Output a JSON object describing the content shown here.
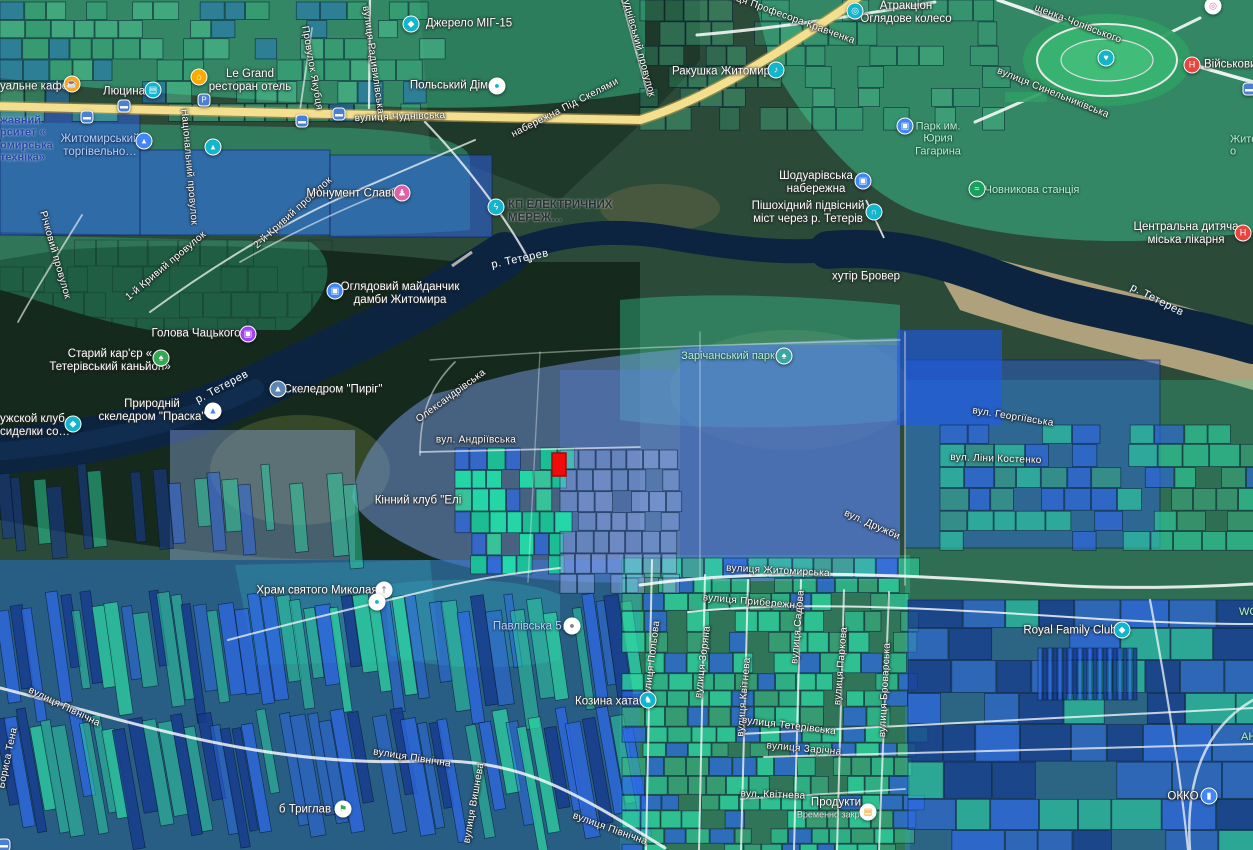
{
  "map": {
    "type": "satellite-cadastral-map",
    "colors": {
      "overlay_green": "#3fd69f",
      "overlay_blue": "#2f6be0",
      "water": "#0c2440",
      "road_yellow": "#f3df8d",
      "selected_parcel_red": "#f30b0b"
    },
    "selected_parcel": {
      "x": 552,
      "y": 453,
      "w": 14,
      "h": 23,
      "fill": "#f30b0b",
      "stroke": "#9e0b0b"
    },
    "street_labels": [
      {
        "n": "street-chudnivska",
        "t": "вулиця Чуднівська",
        "x": 400,
        "y": 117,
        "r": -2
      },
      {
        "n": "street-pid-skeliamy",
        "t": "набережна Під Скелями",
        "x": 565,
        "y": 108,
        "r": -27
      },
      {
        "n": "street-radyvylivska",
        "t": "вулиця Радивилівська",
        "x": 373,
        "y": 60,
        "r": 82
      },
      {
        "n": "street-chudnivskyi-provulok",
        "t": "Чуднівський провулок",
        "x": 638,
        "y": 45,
        "r": 75
      },
      {
        "n": "street-provulok-yakubtsia",
        "t": "Провулок Якубця",
        "x": 312,
        "y": 68,
        "r": 80
      },
      {
        "n": "street-profesora-kravchenka",
        "t": "вулиця Професора Кравченка",
        "x": 785,
        "y": 16,
        "r": 20
      },
      {
        "n": "street-chopivskoho",
        "t": "щенка-Чопівського",
        "x": 1078,
        "y": 24,
        "r": 21
      },
      {
        "n": "street-synelnykivska",
        "t": "вулиця Синельниківська",
        "x": 1053,
        "y": 93,
        "r": 22
      },
      {
        "n": "street-richkovyi-provulok",
        "t": "Річковий провулок",
        "x": 55,
        "y": 255,
        "r": 74
      },
      {
        "n": "street-1-kryvyi-provulok",
        "t": "1-й Кривий провулок",
        "x": 166,
        "y": 266,
        "r": -40
      },
      {
        "n": "street-2-kryvyi-provulok",
        "t": "2-й Кривий провулок",
        "x": 293,
        "y": 213,
        "r": -42
      },
      {
        "n": "street-natsionalnyi-provulok",
        "t": "Національний провулок",
        "x": 189,
        "y": 167,
        "r": 85
      },
      {
        "n": "street-andriivska",
        "t": "вул. Андріївська",
        "x": 476,
        "y": 440,
        "r": 0
      },
      {
        "n": "street-oleksandrivska",
        "t": "Олександрівська",
        "x": 451,
        "y": 396,
        "r": -36
      },
      {
        "n": "street-heorhiivska",
        "t": "вул. Георгіївська",
        "x": 1013,
        "y": 417,
        "r": 9
      },
      {
        "n": "street-liny-kostenko",
        "t": "вул. Ліни Костенко",
        "x": 996,
        "y": 459,
        "r": 2
      },
      {
        "n": "street-druzhby",
        "t": "вул. Дружби",
        "x": 872,
        "y": 525,
        "r": 24
      },
      {
        "n": "street-zhytomyrska",
        "t": "вулиця Житомирська",
        "x": 778,
        "y": 571,
        "r": 3
      },
      {
        "n": "street-pryberezhna",
        "t": "вулиця Прибережна",
        "x": 752,
        "y": 602,
        "r": 5
      },
      {
        "n": "street-polova",
        "t": "вулиця Польова",
        "x": 652,
        "y": 660,
        "r": -83
      },
      {
        "n": "street-zoriana",
        "t": "вулиця Зоряна",
        "x": 703,
        "y": 662,
        "r": -83
      },
      {
        "n": "street-kvitneva-vertical",
        "t": "вулиця Квітнева",
        "x": 744,
        "y": 697,
        "r": -85
      },
      {
        "n": "street-sadova",
        "t": "вулиця Садова",
        "x": 798,
        "y": 627,
        "r": -85
      },
      {
        "n": "street-parkova",
        "t": "вулиця Паркова",
        "x": 841,
        "y": 666,
        "r": -85
      },
      {
        "n": "street-brovarska",
        "t": "вулиця Броварська",
        "x": 885,
        "y": 690,
        "r": -87
      },
      {
        "n": "street-teterivska",
        "t": "вулиця Тетерівська",
        "x": 789,
        "y": 726,
        "r": 7
      },
      {
        "n": "street-zarichna",
        "t": "вулиця Зарічна",
        "x": 804,
        "y": 749,
        "r": 5
      },
      {
        "n": "street-kvitneva-lane",
        "t": "вул. Квітнева",
        "x": 773,
        "y": 795,
        "r": 2
      },
      {
        "n": "street-pivnichna-1",
        "t": "вулиця Північна",
        "x": 610,
        "y": 829,
        "r": 20
      },
      {
        "n": "street-pivnichna-2",
        "t": "вулиця Північна",
        "x": 412,
        "y": 758,
        "r": 9
      },
      {
        "n": "street-pivnichna-3",
        "t": "вулиця Північна",
        "x": 25,
        "y": 707,
        "r": 26,
        "align": "left"
      },
      {
        "n": "street-vyshneva",
        "t": "вулиця Вишнева",
        "x": 474,
        "y": 803,
        "r": -80
      },
      {
        "n": "street-borysa-tena",
        "t": "Бориса Тена",
        "x": 8,
        "y": 758,
        "r": -78
      }
    ],
    "river_labels": [
      {
        "n": "river-teteriv-1",
        "t": "р. Тетерев",
        "x": 520,
        "y": 259,
        "r": -12
      },
      {
        "n": "river-teteriv-2",
        "t": "р. Тетерев",
        "x": 222,
        "y": 387,
        "r": -28
      },
      {
        "n": "river-teteriv-3",
        "t": "р. Тетерев",
        "x": 1157,
        "y": 300,
        "r": 27
      }
    ],
    "place_labels": [
      {
        "n": "poi-cafe",
        "lines": [
          "уальне кафе"
        ],
        "x": 0,
        "y": 87,
        "cls": "poi",
        "align": "left",
        "icon": {
          "n": "cafe-icon",
          "x": 72,
          "y": 84,
          "bg": "#f5a623",
          "glyph": "☕"
        }
      },
      {
        "n": "poi-liutsyna",
        "lines": [
          "Люцина"
        ],
        "x": 124,
        "y": 92,
        "cls": "poi",
        "icon": {
          "n": "shopping-cart-icon",
          "x": 153,
          "y": 90,
          "bg": "#12b5cb",
          "glyph": "▤"
        }
      },
      {
        "n": "poi-le-grand",
        "lines": [
          "Le Grand",
          "ресторан отель"
        ],
        "x": 250,
        "y": 81,
        "cls": "poi",
        "icon": {
          "n": "hotel-icon",
          "x": 199,
          "y": 77,
          "bg": "#f9ab00",
          "glyph": "⌂"
        }
      },
      {
        "n": "poi-dzherelo-mig15",
        "lines": [
          "Джерело МІГ-15"
        ],
        "x": 469,
        "y": 24,
        "cls": "poi",
        "icon": {
          "n": "attraction-icon",
          "x": 411,
          "y": 24,
          "bg": "#12b5cb",
          "glyph": "◆"
        }
      },
      {
        "n": "poi-polskyi-dim",
        "lines": [
          "Польський Дім"
        ],
        "x": 449,
        "y": 86,
        "cls": "poi",
        "icon": {
          "n": "poi-dot-icon",
          "x": 497,
          "y": 86,
          "bg": "#ffffff",
          "fg": "#12b5cb",
          "glyph": "●"
        }
      },
      {
        "n": "poi-rakushka-zhytomyr",
        "lines": [
          "Ракушка Житомир"
        ],
        "x": 721,
        "y": 72,
        "cls": "poi",
        "icon": {
          "n": "music-icon",
          "x": 776,
          "y": 70,
          "bg": "#12b5cb",
          "glyph": "♪"
        }
      },
      {
        "n": "poi-atraktsion-koleso",
        "lines": [
          "Атракціон",
          "Оглядове колесо"
        ],
        "x": 906,
        "y": 13,
        "cls": "poi",
        "icon": {
          "n": "ferris-wheel-icon",
          "x": 855,
          "y": 11,
          "bg": "#12b5cb",
          "glyph": "◎"
        }
      },
      {
        "n": "poi-viiskovyi",
        "lines": [
          "Військови"
        ],
        "x": 1204,
        "y": 65,
        "cls": "poi",
        "align": "left",
        "icon": {
          "n": "hospital-icon",
          "x": 1192,
          "y": 65,
          "bg": "#e8453c",
          "glyph": "Н"
        }
      },
      {
        "n": "poi-park-gagarina",
        "lines": [
          "Парк им.",
          "Юрия",
          "Гагарина"
        ],
        "x": 938,
        "y": 139,
        "cls": "park",
        "icon": {
          "n": "photo-icon",
          "x": 905,
          "y": 126,
          "bg": "#4285f4",
          "glyph": "▣"
        }
      },
      {
        "n": "poi-shoduarivska",
        "lines": [
          "Шодуарівська",
          "набережна"
        ],
        "x": 816,
        "y": 183,
        "cls": "poi",
        "icon": {
          "n": "photo-icon",
          "x": 863,
          "y": 181,
          "bg": "#4285f4",
          "glyph": "▣"
        }
      },
      {
        "n": "poi-pishokhidnyi-mist",
        "lines": [
          "Пішохідний підвісний",
          "міст через р. Тетерів"
        ],
        "x": 808,
        "y": 213,
        "cls": "poi",
        "icon": {
          "n": "bridge-icon",
          "x": 874,
          "y": 212,
          "bg": "#12b5cb",
          "glyph": "∩"
        }
      },
      {
        "n": "poi-chovnykova-stantsiia",
        "lines": [
          "Човникова станція"
        ],
        "x": 1032,
        "y": 190,
        "cls": "park",
        "icon": {
          "n": "boat-station-icon",
          "x": 977,
          "y": 189,
          "bg": "#18a05c",
          "glyph": "≈"
        }
      },
      {
        "n": "poi-dytiacha-likarnia",
        "lines": [
          "Центральна дитяча",
          "міська лікарня"
        ],
        "x": 1186,
        "y": 234,
        "cls": "poi",
        "icon": {
          "n": "hospital-icon",
          "x": 1243,
          "y": 233,
          "bg": "#e8453c",
          "glyph": "Н"
        }
      },
      {
        "n": "poi-zhyto-partial",
        "lines": [
          "Жито",
          "о"
        ],
        "x": 1230,
        "y": 146,
        "cls": "park",
        "align": "left"
      },
      {
        "n": "poi-monument-slavy",
        "lines": [
          "Монумент Слави"
        ],
        "x": 352,
        "y": 194,
        "cls": "poi",
        "icon": {
          "n": "monument-icon",
          "x": 402,
          "y": 193,
          "bg": "#e060a8",
          "glyph": "♟"
        }
      },
      {
        "n": "poi-kp-elektrychnykh",
        "lines": [
          "КП ЕЛЕКТРИЧНИХ",
          "МЕРЕЖ…"
        ],
        "x": 508,
        "y": 212,
        "cls": "dark",
        "align": "left",
        "icon": {
          "n": "electric-icon",
          "x": 496,
          "y": 207,
          "bg": "#12b5cb",
          "glyph": "ϟ"
        }
      },
      {
        "n": "poi-khutir-brover",
        "lines": [
          "хутір Бровер"
        ],
        "x": 866,
        "y": 277,
        "cls": "poi"
      },
      {
        "n": "poi-ohliadovyi-maidanchyk",
        "lines": [
          "Оглядовий майданчик",
          "дамби Житомира"
        ],
        "x": 400,
        "y": 294,
        "cls": "poi",
        "icon": {
          "n": "photo-icon",
          "x": 335,
          "y": 291,
          "bg": "#4285f4",
          "glyph": "▣"
        }
      },
      {
        "n": "poi-holova-chatskoho",
        "lines": [
          "Голова Чацького"
        ],
        "x": 196,
        "y": 334,
        "cls": "poi",
        "icon": {
          "n": "photo-icon",
          "x": 248,
          "y": 334,
          "bg": "#a142f4",
          "glyph": "▣"
        }
      },
      {
        "n": "poi-staryi-karier",
        "lines": [
          "Старий кар'єр «",
          "Тетерівський каньйон»"
        ],
        "x": 110,
        "y": 361,
        "cls": "poi",
        "icon": {
          "n": "nature-icon",
          "x": 161,
          "y": 358,
          "bg": "#34a853",
          "glyph": "♠"
        }
      },
      {
        "n": "poi-skeledrom-pyrih",
        "lines": [
          "Скеледром \"Пиріг\""
        ],
        "x": 333,
        "y": 390,
        "cls": "poi",
        "icon": {
          "n": "climbing-icon",
          "x": 278,
          "y": 389,
          "bg": "#5c87b2",
          "glyph": "▲"
        }
      },
      {
        "n": "poi-skeledrom-praska",
        "lines": [
          "Природній",
          "скеледром \"Праска\""
        ],
        "x": 152,
        "y": 411,
        "cls": "poi",
        "icon": {
          "n": "climbing-icon",
          "x": 213,
          "y": 411,
          "bg": "#ffffff",
          "fg": "#4285f4",
          "glyph": "▲"
        }
      },
      {
        "n": "poi-muzhskoi-klub",
        "lines": [
          "ужской клуб",
          "сиделки со…"
        ],
        "x": 0,
        "y": 426,
        "cls": "poi",
        "align": "left",
        "icon": {
          "n": "club-icon",
          "x": 73,
          "y": 424,
          "bg": "#12b5cb",
          "glyph": "◆"
        }
      },
      {
        "n": "poi-kinnyi-klub",
        "lines": [
          "Кінний клуб \"Елі"
        ],
        "x": 418,
        "y": 501,
        "cls": "poi"
      },
      {
        "n": "poi-zarichanskyi-park",
        "lines": [
          "Зарічанський парк"
        ],
        "x": 728,
        "y": 356,
        "cls": "park",
        "icon": {
          "n": "park-tree-icon",
          "x": 784,
          "y": 356,
          "bg": "#3aa7a3",
          "glyph": "♠"
        }
      },
      {
        "n": "poi-khram-mykolaia",
        "lines": [
          "Храм святого Миколая"
        ],
        "x": 317,
        "y": 591,
        "cls": "poi",
        "icon": {
          "n": "church-icon",
          "x": 384,
          "y": 590,
          "bg": "#ffffff",
          "fg": "#5f6368",
          "glyph": "†"
        }
      },
      {
        "n": "poi-pavlivska-5",
        "lines": [
          "Павлівська 5…"
        ],
        "x": 533,
        "y": 627,
        "cls": "blue",
        "icon": {
          "n": "address-icon",
          "x": 572,
          "y": 626,
          "bg": "#ffffff",
          "fg": "#80868b",
          "glyph": "●"
        }
      },
      {
        "n": "poi-kozyna-khata",
        "lines": [
          "Козина хата"
        ],
        "x": 607,
        "y": 702,
        "cls": "poi",
        "icon": {
          "n": "farm-icon",
          "x": 648,
          "y": 700,
          "bg": "#12b5cb",
          "glyph": "♞"
        }
      },
      {
        "n": "poi-royal-family-club",
        "lines": [
          "Royal Family Club"
        ],
        "x": 1070,
        "y": 631,
        "cls": "poi",
        "icon": {
          "n": "venue-icon",
          "x": 1122,
          "y": 630,
          "bg": "#12b5cb",
          "glyph": "◆"
        }
      },
      {
        "n": "poi-tryhlav",
        "lines": [
          "б Триглав"
        ],
        "x": 305,
        "y": 810,
        "cls": "poi",
        "icon": {
          "n": "flag-icon",
          "x": 343,
          "y": 809,
          "bg": "#ffffff",
          "fg": "#34a853",
          "glyph": "⚑"
        }
      },
      {
        "n": "poi-produkty",
        "lines": [
          "Продукти"
        ],
        "sub": "Временно закрыто",
        "x": 836,
        "y": 808,
        "cls": "poi",
        "icon": {
          "n": "grocery-icon",
          "x": 868,
          "y": 812,
          "bg": "#ffffff",
          "fg": "#f29900",
          "glyph": "▤"
        }
      },
      {
        "n": "poi-okko",
        "lines": [
          "ОККО"
        ],
        "x": 1183,
        "y": 797,
        "cls": "poi",
        "icon": {
          "n": "fuel-icon",
          "x": 1209,
          "y": 796,
          "bg": "#4285f4",
          "glyph": "▮"
        }
      },
      {
        "n": "poi-torhivelnyi",
        "lines": [
          "Житомирський",
          "торгівельно…"
        ],
        "x": 100,
        "y": 146,
        "cls": "blue",
        "icon": {
          "n": "university-icon",
          "x": 144,
          "y": 141,
          "bg": "#4285f4",
          "glyph": "▴"
        }
      },
      {
        "n": "poi-universytet-clipped",
        "lines": [
          "жавний",
          "рситет «",
          "омирська",
          "техніка»"
        ],
        "x": 0,
        "y": 139,
        "cls": "navy",
        "align": "left"
      },
      {
        "n": "poi-school-icon-only",
        "lines": [],
        "x": 213,
        "y": 147,
        "cls": "poi",
        "icon": {
          "n": "school-icon",
          "x": 213,
          "y": 147,
          "bg": "#12b5cb",
          "glyph": "▴"
        }
      },
      {
        "n": "poi-wo-partial",
        "lines": [
          "WO"
        ],
        "x": 1239,
        "y": 612,
        "cls": "park",
        "align": "left"
      },
      {
        "n": "poi-an-partial",
        "lines": [
          "АН"
        ],
        "x": 1241,
        "y": 737,
        "cls": "park",
        "align": "left"
      },
      {
        "n": "poi-attraction-top-right",
        "lines": [],
        "x": 1213,
        "y": 6,
        "cls": "poi",
        "icon": {
          "n": "attraction-icon",
          "x": 1213,
          "y": 6,
          "bg": "#ffffff",
          "fg": "#e060a8",
          "glyph": "◎"
        }
      },
      {
        "n": "poi-dot-small",
        "lines": [],
        "x": 377,
        "y": 602,
        "cls": "poi",
        "icon": {
          "n": "poi-dot-icon",
          "x": 377,
          "y": 602,
          "bg": "#ffffff",
          "fg": "#12b5cb",
          "glyph": "●"
        }
      },
      {
        "n": "poi-stadium-saved",
        "lines": [],
        "x": 1106,
        "y": 58,
        "cls": "poi",
        "icon": {
          "n": "heart-pin-icon",
          "x": 1106,
          "y": 58,
          "bg": "#12b5cb",
          "glyph": "♥"
        }
      }
    ],
    "transit_icons": [
      {
        "n": "bus-stop-icon",
        "x": 87,
        "y": 117,
        "bg": "#4a7fd4",
        "glyph": "▬"
      },
      {
        "n": "bus-stop-icon",
        "x": 124,
        "y": 106,
        "bg": "#4a7fd4",
        "glyph": "▬"
      },
      {
        "n": "bus-stop-icon",
        "x": 302,
        "y": 121,
        "bg": "#4a7fd4",
        "glyph": "▬"
      },
      {
        "n": "bus-stop-icon",
        "x": 339,
        "y": 114,
        "bg": "#4a7fd4",
        "glyph": "▬"
      },
      {
        "n": "bus-stop-icon",
        "x": 1249,
        "y": 89,
        "bg": "#4a7fd4",
        "glyph": "▬"
      },
      {
        "n": "bus-stop-icon",
        "x": 4,
        "y": 845,
        "bg": "#4a7fd4",
        "glyph": "▬"
      },
      {
        "n": "parking-icon",
        "x": 204,
        "y": 100,
        "bg": "#4a7fd4",
        "glyph": "P"
      }
    ]
  }
}
